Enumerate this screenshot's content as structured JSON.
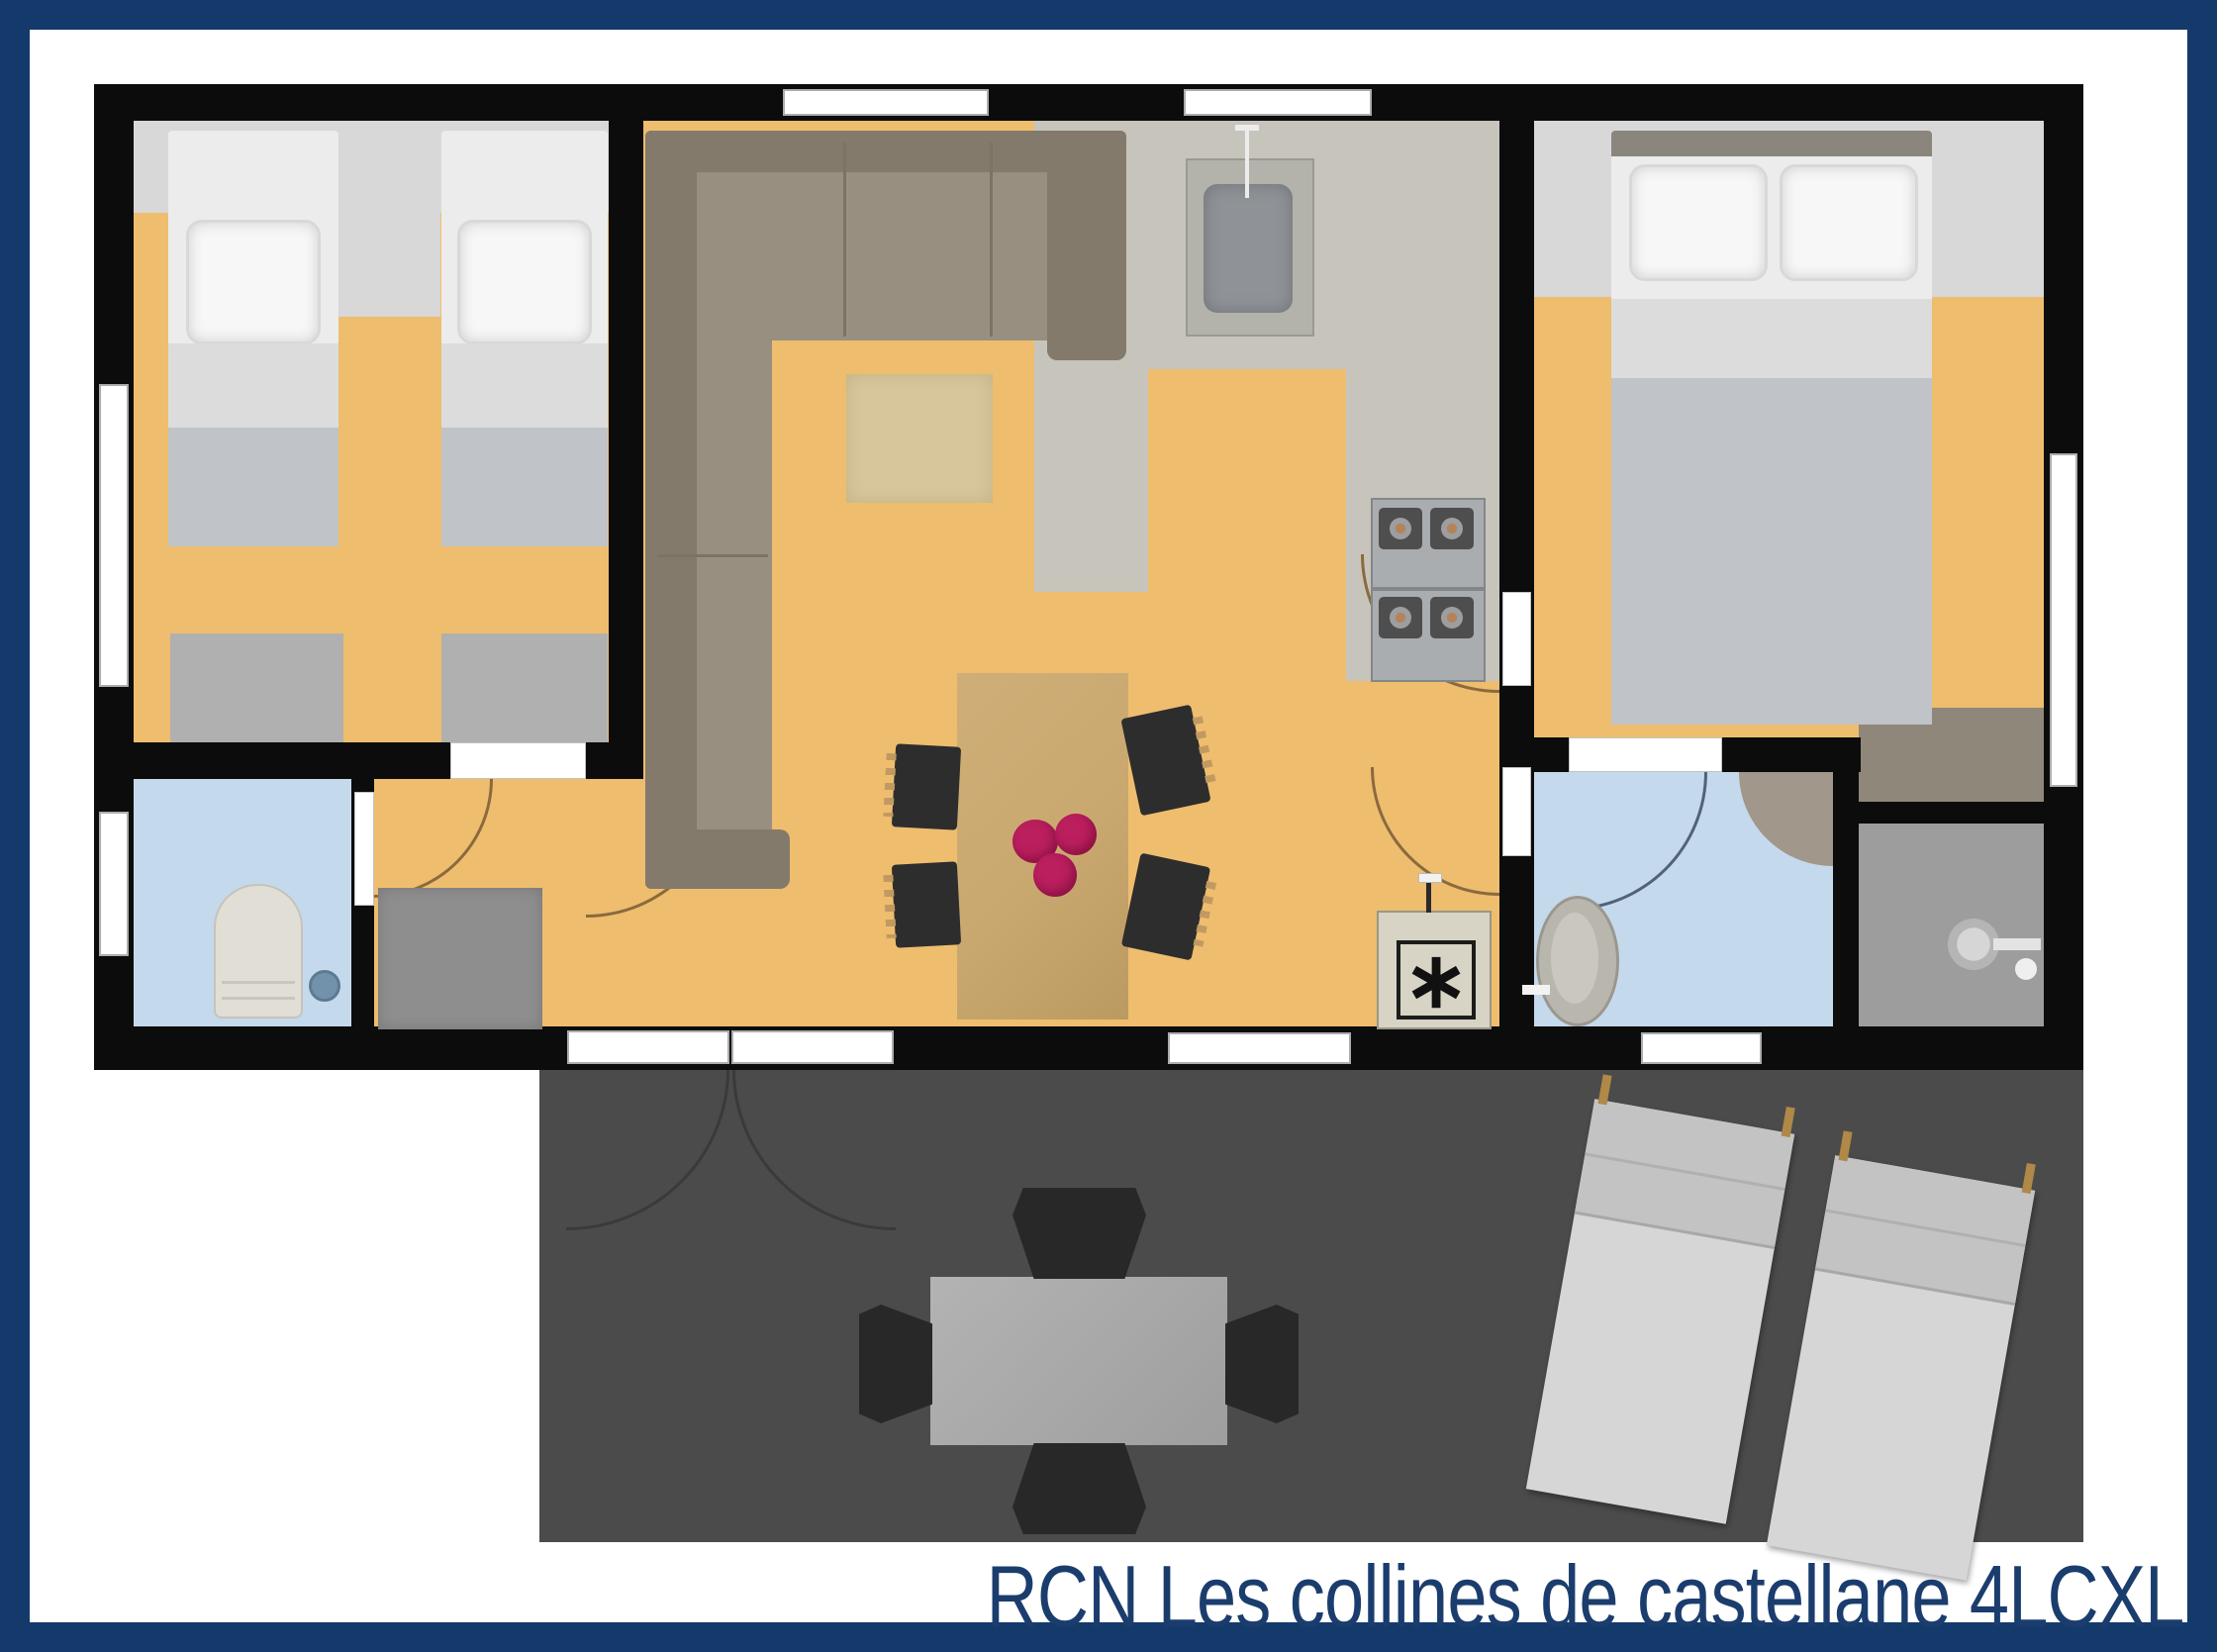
{
  "title": {
    "text": "RCN Les collines de castellane 4LCXL",
    "color": "#1b3d6e"
  },
  "palette": {
    "border_navy": "#143a6b",
    "wall": "#0c0c0c",
    "floor_orange": "#eebd6e",
    "floor_kitchen": "#c7c5bb",
    "floor_blue": "#c5d9ec",
    "floor_closet": "#8f877a",
    "floor_shower": "#9d9d9d",
    "terrace": "#4b4b4b",
    "headboard_strip": "#d8d8d8",
    "sofa": "#998f80",
    "sofa_dark": "#837a6c",
    "rug": "#d7c69c",
    "wood_table": "#c9a870",
    "flowers": "#bb1f5e",
    "bed_linen": "#ececec",
    "blanket": "#c0c3c7",
    "mat": "#b0b0b0",
    "doormat": "#8e8e8e",
    "chair_dark": "#2d2d2d",
    "chair_wood": "#c19a62",
    "lounger": "#d6d6d6",
    "window_white": "#ffffff",
    "toilet_body": "#e1ded6",
    "corner_shower": "#a1978a",
    "heater_body": "#d7d4c5"
  },
  "fixtures": {
    "left_bedroom": "two single beds",
    "right_bedroom": "double bed",
    "living": "corner sofa, rug, dining table with 4 chairs and flowers",
    "kitchen": "sink, 4-burner stove",
    "toilet_room": "toilet, floor drain",
    "bathroom": "washbasin, corner shower",
    "shower_room": "wall shower",
    "utility": "water heater (asterisk symbol)",
    "terrace": "patio table with 4 chairs, two sun loungers"
  },
  "heater_symbol": "∗"
}
